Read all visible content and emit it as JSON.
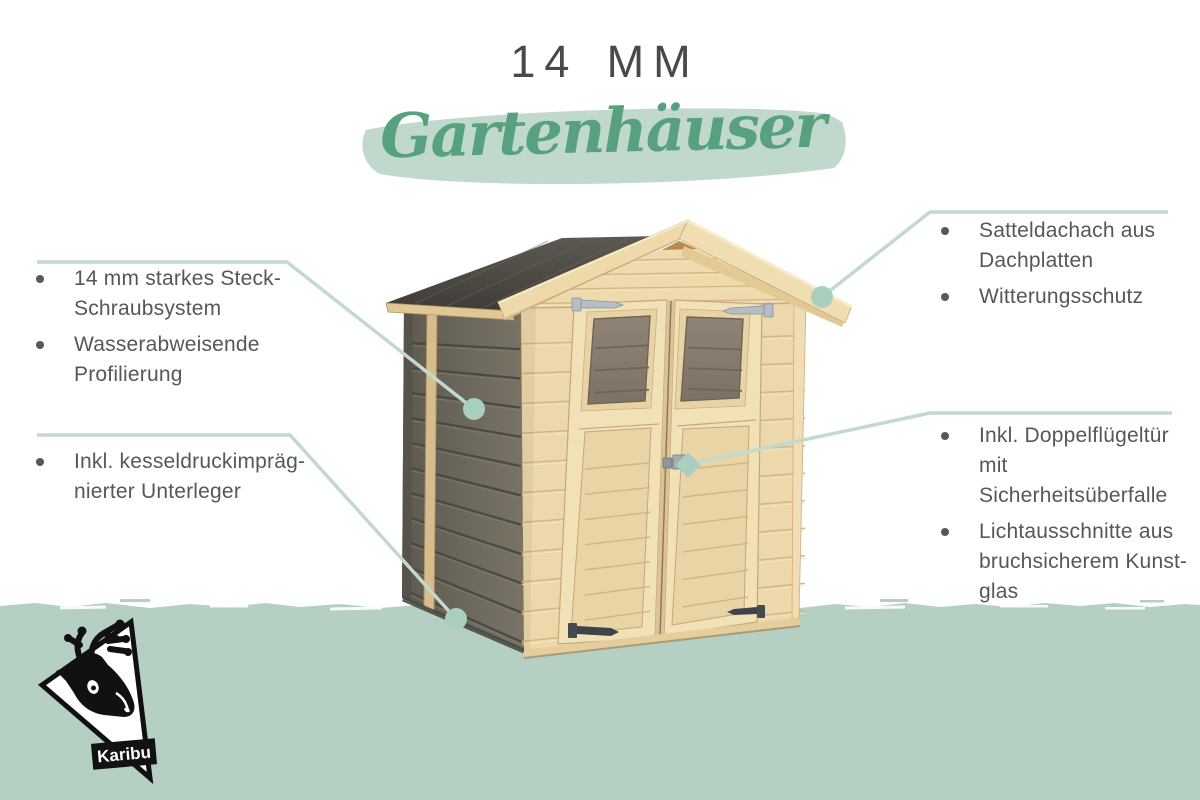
{
  "header": {
    "size_label": "14 MM",
    "category": "Gartenhäuser"
  },
  "features": {
    "left_top": [
      {
        "lines": [
          "14 mm starkes Steck-",
          "Schraubsystem"
        ]
      },
      {
        "lines": [
          "Wasserabweisende",
          "Profilierung"
        ]
      }
    ],
    "left_bottom": [
      {
        "lines": [
          "Inkl. kesseldruckimpräg-",
          "nierter Unterleger"
        ]
      }
    ],
    "right_top": [
      {
        "lines": [
          "Satteldachach aus",
          "Dachplatten"
        ]
      },
      {
        "lines": [
          "Witterungsschutz"
        ]
      }
    ],
    "right_bottom": [
      {
        "lines": [
          "Inkl. Doppelflügeltür",
          "mit Sicherheitsüberfalle"
        ]
      },
      {
        "lines": [
          "Lichtausschnitte aus",
          "bruchsicherem Kunst-",
          "glas"
        ]
      }
    ]
  },
  "illustration": {
    "subject": "wooden garden shed with gable roof and double doors",
    "callout_markers": [
      "side-wall-dot",
      "foundation-dot",
      "roof-edge-dot",
      "door-handle-diamond"
    ]
  },
  "logo": {
    "brand": "Karibu"
  },
  "colors": {
    "title_text": "#49484d",
    "subtitle_text": "#57a17e",
    "subtitle_brush": "#c0d9cc",
    "body_text": "#55575c",
    "callout_line": "#c3d9cd",
    "callout_dot": "#a9cfc0",
    "ground": "#b5cfc2",
    "pine_wood": "#ecd8aa",
    "weathered_wall": "#6b675b",
    "roof_panel": "#4b4842"
  }
}
